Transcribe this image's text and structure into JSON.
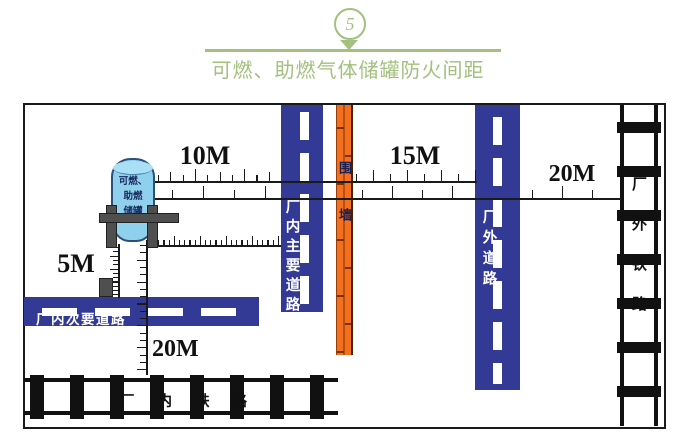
{
  "header": {
    "badge_number": "5",
    "title": "可燃、助燃气体储罐防火间距"
  },
  "diagram": {
    "tank_label": "可燃、\n助燃\n储罐",
    "labels": {
      "main_road": "厂内主要道路",
      "wall": "围墙",
      "external_road": "厂外道路",
      "external_railway": "厂外铁路",
      "secondary_road": "厂内次要道路",
      "internal_railway": "厂内铁路"
    },
    "dimensions": {
      "tank_to_main_road": "10M",
      "wall_to_external_road": "15M",
      "external_road_to_railway": "20M",
      "tank_to_secondary_road": "5M",
      "tank_to_internal_railway": "20M"
    },
    "colors": {
      "road_blue": "#333a96",
      "wall_orange": "#f2701f",
      "tank_blue": "#8fd0ec",
      "accent_green": "#a2c07e"
    }
  }
}
